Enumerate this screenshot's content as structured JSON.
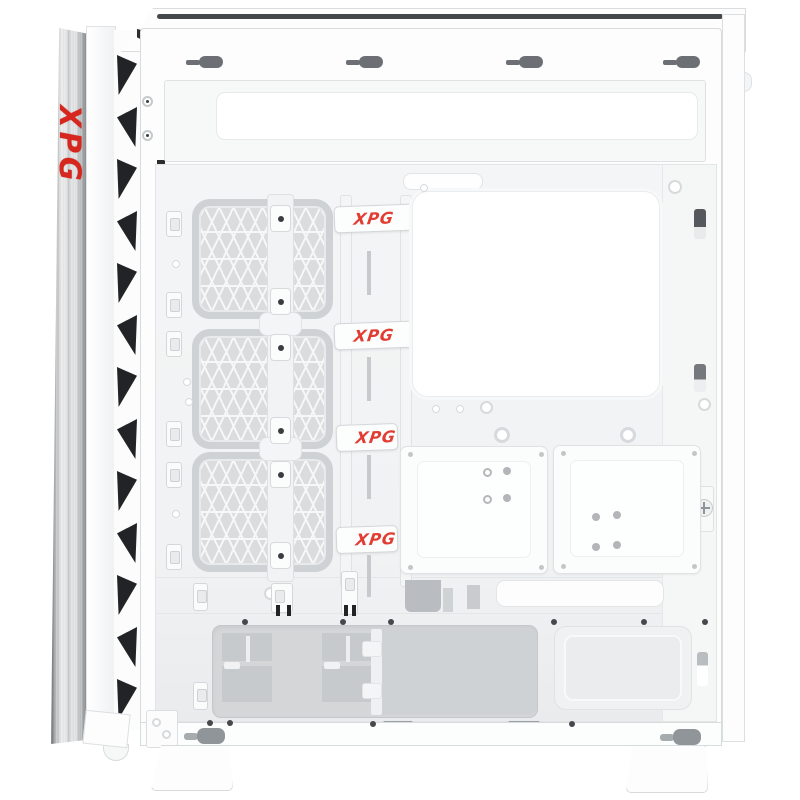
{
  "product": {
    "brand": "XPG",
    "view": "pc case side interior, panel removed"
  },
  "front_panel": {
    "logo_text": "XPG",
    "logo_color": "#d7261d",
    "vent_triangle_count": 13,
    "triangle_color": "#212326"
  },
  "cable_straps": {
    "labels": [
      "XPG",
      "XPG",
      "XPG",
      "XPG"
    ],
    "text_color": "#e23d33",
    "clipped_straps": [
      3,
      4
    ]
  },
  "fan_wall": {
    "frame_count": 3,
    "mesh_color": "#dadcde"
  },
  "top_panel": {
    "mount_slot_count": 4,
    "slot_color": "#6c7074"
  },
  "colors": {
    "body": "#ffffff",
    "interior": "#f2f3f4",
    "outline": "#d8dbdd",
    "recess_gray": "#d4d6d8",
    "accent_red": "#d7261d",
    "metal_strip": "brushed-aluminum"
  }
}
